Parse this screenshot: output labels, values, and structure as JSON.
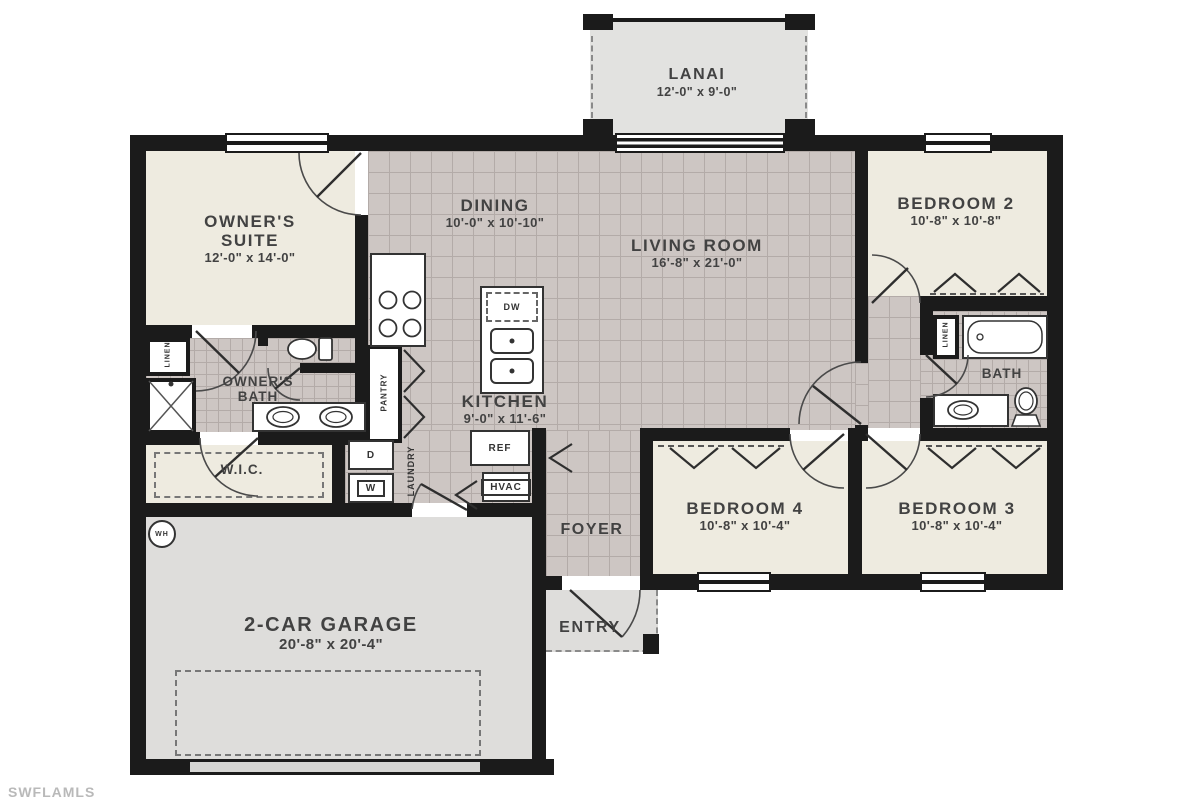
{
  "watermark": "SWFLAMLS",
  "rooms": {
    "lanai": {
      "name": "LANAI",
      "dims": "12'-0\" x 9'-0\""
    },
    "owners_suite": {
      "name": "OWNER'S SUITE",
      "dims": "12'-0\" x 14'-0\""
    },
    "dining": {
      "name": "DINING",
      "dims": "10'-0\" x 10'-10\""
    },
    "living_room": {
      "name": "LIVING ROOM",
      "dims": "16'-8\" x 21'-0\""
    },
    "bedroom2": {
      "name": "BEDROOM 2",
      "dims": "10'-8\" x 10'-8\""
    },
    "kitchen": {
      "name": "KITCHEN",
      "dims": "9'-0\" x 11'-6\""
    },
    "owners_bath": {
      "name": "OWNER'S BATH"
    },
    "bath": {
      "name": "BATH"
    },
    "wic": {
      "name": "W.I.C."
    },
    "bedroom4": {
      "name": "BEDROOM 4",
      "dims": "10'-8\" x 10'-4\""
    },
    "bedroom3": {
      "name": "BEDROOM 3",
      "dims": "10'-8\" x 10'-4\""
    },
    "foyer": {
      "name": "FOYER"
    },
    "entry": {
      "name": "ENTRY"
    },
    "garage": {
      "name": "2-CAR GARAGE",
      "dims": "20'-8\" x 20'-4\""
    }
  },
  "fixtures": {
    "linen_owner": "LINEN",
    "linen_bath": "LINEN",
    "pantry": "PANTRY",
    "laundry": "LAUNDRY",
    "dishwasher": "DW",
    "refrigerator": "REF",
    "hvac": "HVAC",
    "washer": "W",
    "dryer": "D",
    "water_heater": "WH"
  },
  "colors": {
    "wall": "#1b1b1b",
    "tile": "#cdc6c3",
    "tile_grid": "#b3aba8",
    "carpet": "#eeebe0",
    "concrete": "#dedddb",
    "lanai": "#e2e2e0",
    "label": "#424242",
    "watermark": "#b9b9b9"
  }
}
